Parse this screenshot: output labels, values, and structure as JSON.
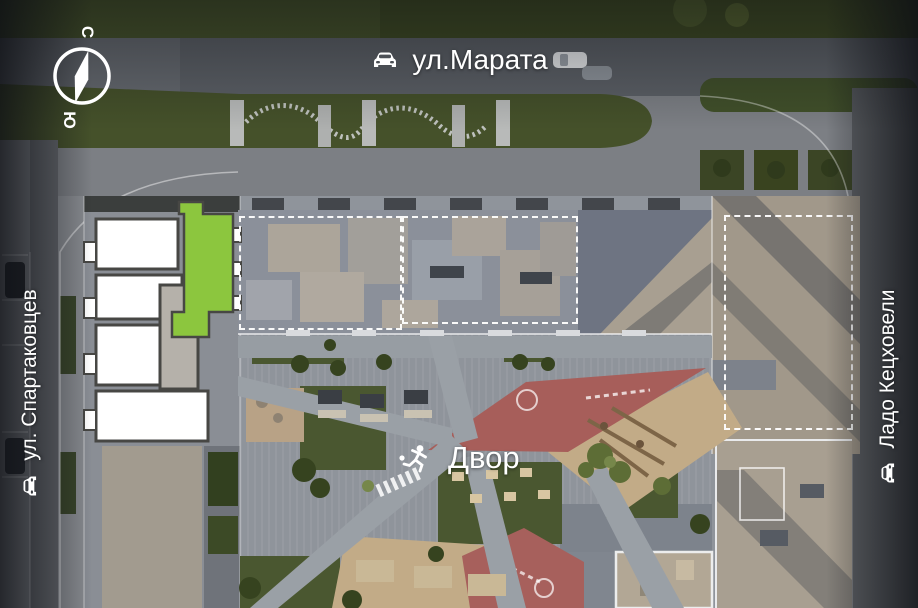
{
  "compass": {
    "north": "С",
    "south": "Ю"
  },
  "streets": {
    "top": {
      "label": "ул.Марата",
      "icon": "car-icon"
    },
    "left": {
      "label": "ул. Спартаковцев",
      "icon": "car-icon"
    },
    "right": {
      "label": "Ладо Кецховели",
      "icon": "car-icon"
    }
  },
  "courtyard": {
    "label": "Двор",
    "icon": "pedestrian-icon"
  },
  "colors": {
    "highlight_green": "#8cc63e",
    "plan_white": "#ffffff",
    "plan_wall": "#474744",
    "plan_core_gray": "#b5b1aa",
    "road_gray": "#5c6066",
    "side_road_gray": "#64676c",
    "sidewalk_gray": "#7c7f84",
    "grass_dark": "#3e4a23",
    "lawn_green": "#4a5730",
    "roof_gray": "#8b909a",
    "roof_beige": "#a89f91",
    "playground_red": "#a75e5a",
    "sand_tan": "#c2ab87",
    "path_gray": "#9aa0a6",
    "outline_dashed": "#ffffff",
    "label_white": "#ffffff"
  }
}
